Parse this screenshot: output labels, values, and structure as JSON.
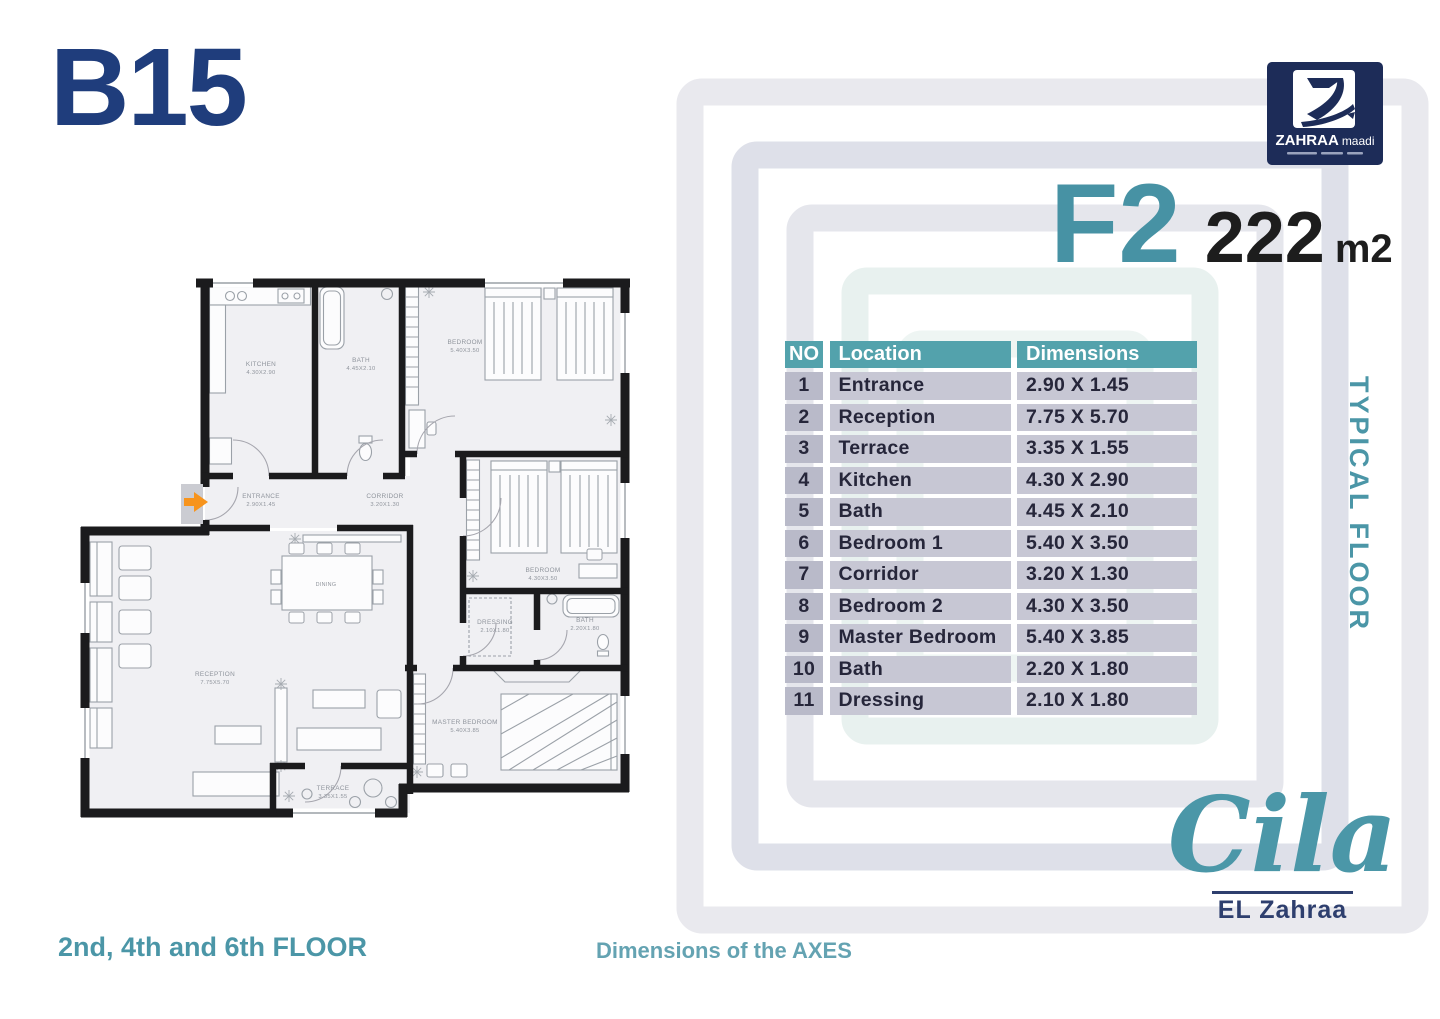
{
  "header": {
    "unit_code": "B15"
  },
  "brand": {
    "name": "ZAHRAA",
    "suffix": "maadi"
  },
  "unit": {
    "model": "F2",
    "area": "222",
    "area_unit": "m2"
  },
  "side_label": "TYPICAL FLOOR",
  "table": {
    "headers": {
      "no": "NO",
      "location": "Location",
      "dimensions": "Dimensions"
    },
    "rows": [
      {
        "no": "1",
        "location": "Entrance",
        "dimensions": "2.90 X 1.45"
      },
      {
        "no": "2",
        "location": "Reception",
        "dimensions": "7.75 X 5.70"
      },
      {
        "no": "3",
        "location": "Terrace",
        "dimensions": "3.35 X 1.55"
      },
      {
        "no": "4",
        "location": "Kitchen",
        "dimensions": "4.30 X 2.90"
      },
      {
        "no": "5",
        "location": "Bath",
        "dimensions": "4.45 X 2.10"
      },
      {
        "no": "6",
        "location": "Bedroom 1",
        "dimensions": "5.40 X 3.50"
      },
      {
        "no": "7",
        "location": "Corridor",
        "dimensions": "3.20 X 1.30"
      },
      {
        "no": "8",
        "location": "Bedroom 2",
        "dimensions": "4.30 X 3.50"
      },
      {
        "no": "9",
        "location": "Master Bedroom",
        "dimensions": "5.40 X 3.85"
      },
      {
        "no": "10",
        "location": "Bath",
        "dimensions": "2.20 X 1.80"
      },
      {
        "no": "11",
        "location": "Dressing",
        "dimensions": "2.10 X 1.80"
      }
    ]
  },
  "footer": {
    "floors": "2nd, 4th and 6th FLOOR",
    "axes": "Dimensions of the AXES"
  },
  "project": {
    "name": "Cila",
    "sub_name": "EL Zahraa"
  },
  "floorplan": {
    "rooms": [
      {
        "name": "KITCHEN",
        "dims": "4.30X2.90"
      },
      {
        "name": "BATH",
        "dims": "4.45X2.10"
      },
      {
        "name": "BEDROOM",
        "dims": "5.40X3.50"
      },
      {
        "name": "BEDROOM",
        "dims": "4.30X3.50"
      },
      {
        "name": "ENTRANCE",
        "dims": "2.90X1.45"
      },
      {
        "name": "CORRIDOR",
        "dims": "3.20X1.30"
      },
      {
        "name": "RECEPTION",
        "dims": "7.75X5.70"
      },
      {
        "name": "DINING",
        "dims": ""
      },
      {
        "name": "DRESSING",
        "dims": "2.10X1.80"
      },
      {
        "name": "BATH",
        "dims": "2.20X1.80"
      },
      {
        "name": "MASTER BEDROOM",
        "dims": "5.40X3.85"
      },
      {
        "name": "TERRACE",
        "dims": "3.35X1.55"
      }
    ]
  },
  "colors": {
    "navy": "#1f3d7c",
    "teal": "#4b97a8",
    "table_header_teal": "#53a2ac",
    "row_bg": "#c7c7d4",
    "row_no_bg": "#b9bac9",
    "logo_navy": "#1d2c58",
    "entry_arrow_orange": "#f7941d"
  }
}
